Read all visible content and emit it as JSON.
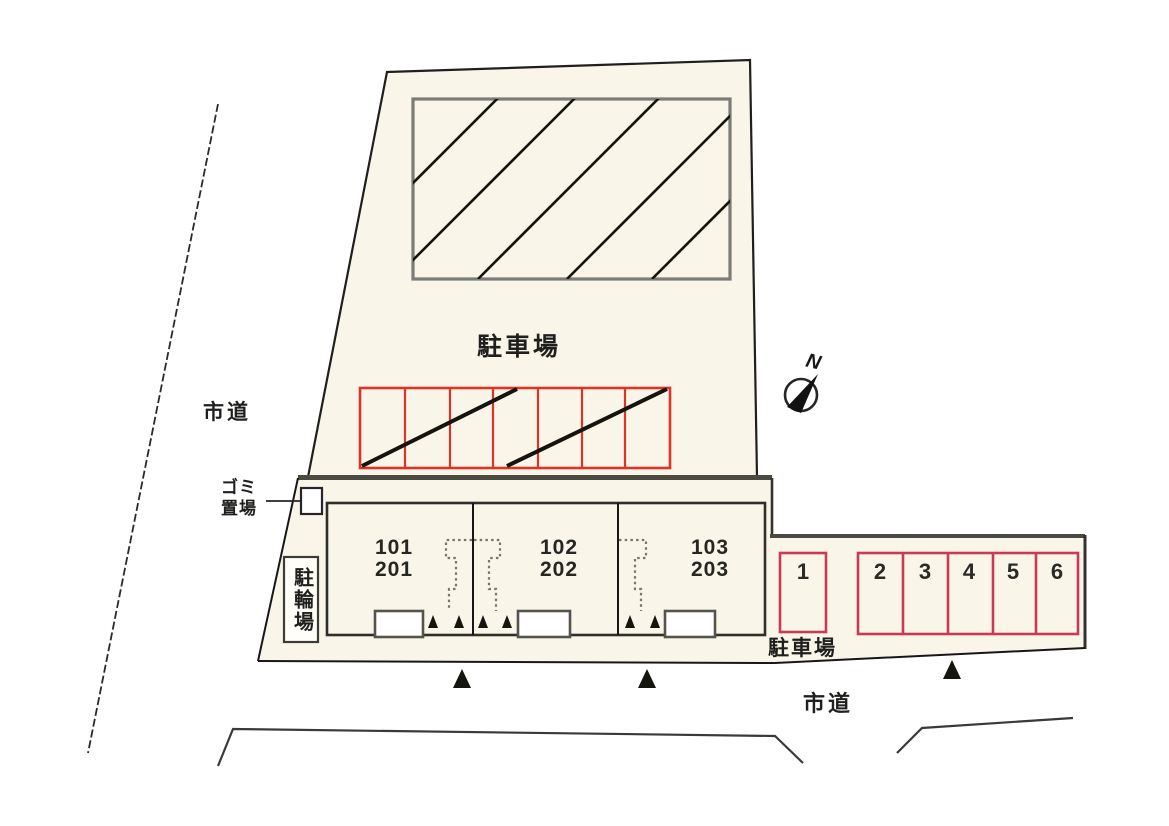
{
  "site_plan": {
    "title": "site layout plan",
    "roads": {
      "left_label": "市道",
      "bottom_label": "市道"
    },
    "upper_lot": {
      "label": "駐車場",
      "stall_count": 7
    },
    "trash_area": {
      "label_line1": "ゴミ",
      "label_line2": "置場"
    },
    "bicycle_area": {
      "label": "駐輪場"
    },
    "building": {
      "units": [
        {
          "first_floor": "101",
          "second_floor": "201"
        },
        {
          "first_floor": "102",
          "second_floor": "202"
        },
        {
          "first_floor": "103",
          "second_floor": "203"
        }
      ]
    },
    "right_lot": {
      "label": "駐車場",
      "spaces": [
        "1",
        "2",
        "3",
        "4",
        "5",
        "6"
      ]
    },
    "compass": {
      "label": "N"
    },
    "colors": {
      "site_fill": "#f9f5e8",
      "upper_stalls_border": "#dc3426",
      "right_stalls_border": "#c93a56",
      "hatch_area_border": "#7b7b78",
      "outline": "#1f1f1d",
      "thick_boundary": "#4a4a40"
    }
  }
}
